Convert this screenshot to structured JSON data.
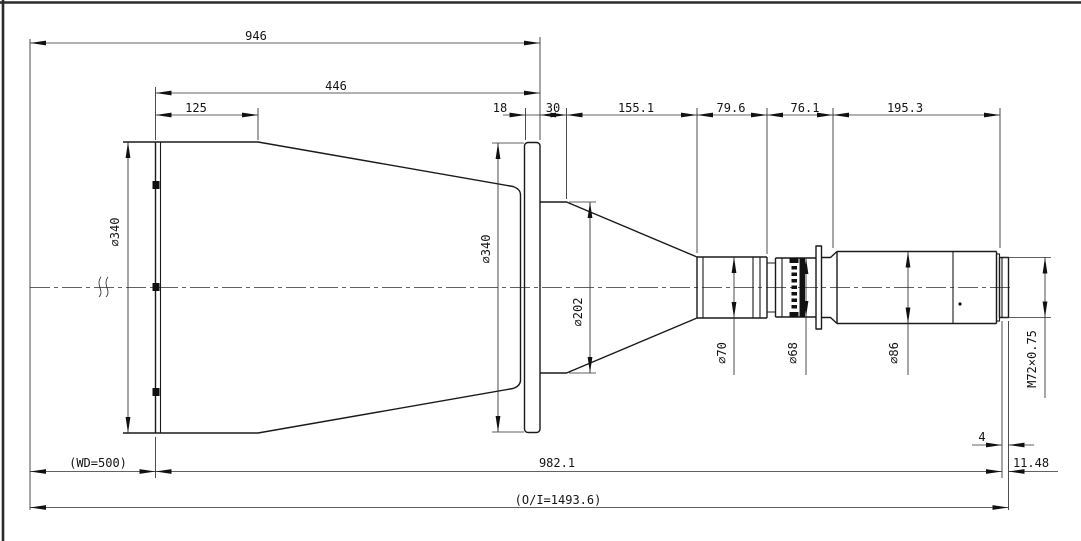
{
  "drawing_title": "lens-assembly-dimension-drawing",
  "dims_top": {
    "overall_front": "946",
    "hood_to_flange": "446",
    "hood_front": "125",
    "flange_thickness": "18",
    "flange_step": "30",
    "taper_length": "155.1",
    "mid_length": "79.6",
    "ring_length": "76.1",
    "barrel_length": "195.3"
  },
  "dims_bottom": {
    "working_distance": "(WD=500)",
    "body_length": "982.1",
    "rear_gap": "4",
    "flange_back": "11.48",
    "object_image": "(O/I=1493.6)"
  },
  "diameters": {
    "hood": "∅340",
    "flange": "∅340",
    "cone": "∅202",
    "mid": "∅70",
    "ring": "∅68",
    "barrel": "∅86",
    "thread": "M72×0.75"
  },
  "colors": {
    "line": "#1a1a1a",
    "background": "#ffffff"
  }
}
